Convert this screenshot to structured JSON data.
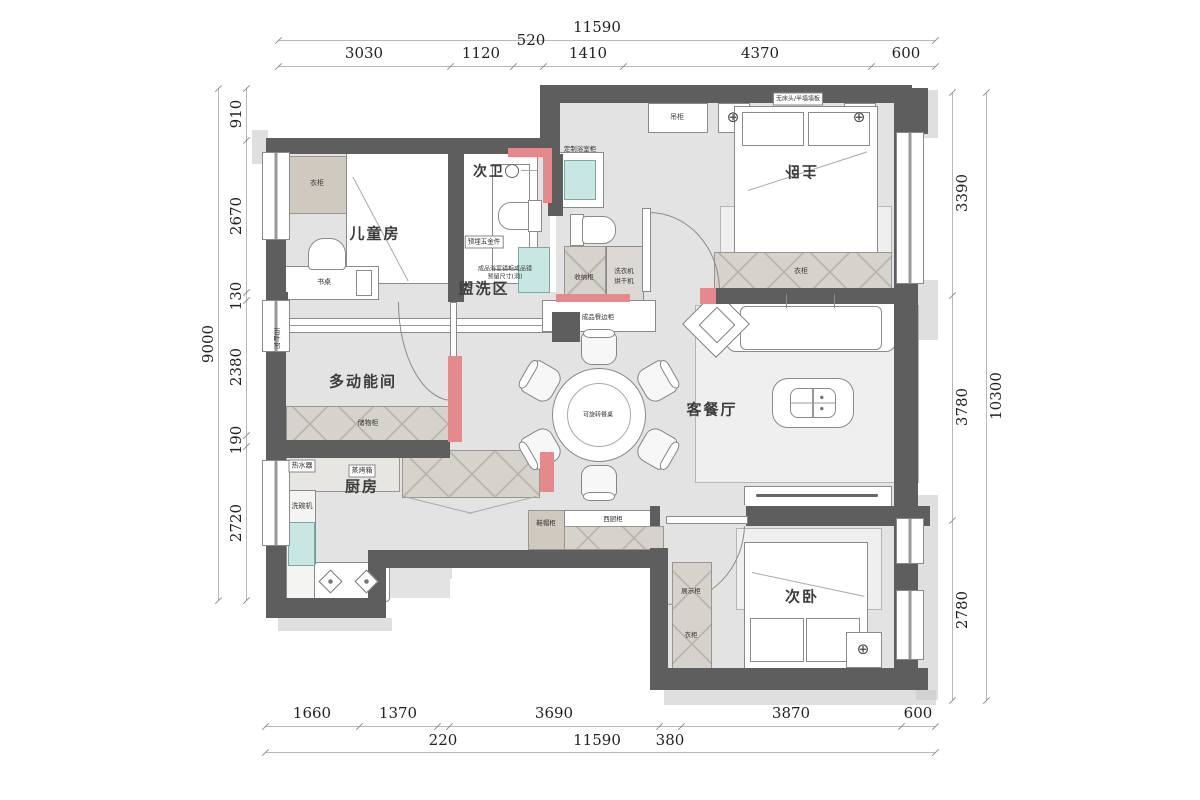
{
  "title": "apartment-floor-plan",
  "colors": {
    "wall": "#5e5e5e",
    "accent_red": "#e5898c",
    "fixture_teal": "#c8e6e2",
    "floor": "#e3e3e3"
  },
  "dims": {
    "top": {
      "total": "11590",
      "segments": [
        "3030",
        "1120",
        "520",
        "1410",
        "4370",
        "600"
      ]
    },
    "left": {
      "total": "9000",
      "segments": [
        "910",
        "2670",
        "130",
        "2380",
        "190",
        "2720"
      ]
    },
    "right": {
      "total": "10300",
      "segments": [
        "3390",
        "3780",
        "2780"
      ]
    },
    "bottom": {
      "row1": [
        "1660",
        "1370",
        "3690",
        "3870",
        "600"
      ],
      "row2": [
        "220",
        "11590",
        "380"
      ]
    }
  },
  "rooms": {
    "children": "儿童房",
    "bath2": "次卫",
    "master": "主卧",
    "wash": "盥洗区",
    "multi": "多动能间",
    "living": "客餐厅",
    "kitchen": "厨房",
    "bed2": "次卧"
  },
  "furniture": {
    "wardrobe_child": "衣柜",
    "desk": "书桌",
    "blinds": "百叶帘",
    "storage_multi": "储物柜",
    "water_heater": "热水器",
    "steam_oven": "蒸烤箱",
    "dishwasher": "洗碗机",
    "hanging_cabinet": "吊柜",
    "no_headboard": "无床头/半墙墙板",
    "wardrobe_master": "衣柜",
    "custom_vanity": "定制浴室柜",
    "embedded_hw": "预埋五金件",
    "mirror_l1": "成品浴室镜柜成品镜",
    "mirror_l2": "预留尺寸(洞)",
    "storage_wash": "收纳柜",
    "washer_l1": "洗衣机",
    "washer_l2": "烘干机",
    "sideboard": "成品餐边柜",
    "dining_table": "可旋转餐桌",
    "shoe_cabinet": "鞋帽柜",
    "west_kitchen_cabinet": "西厨柜",
    "display_cabinet": "展示柜",
    "wardrobe_second": "衣柜"
  }
}
